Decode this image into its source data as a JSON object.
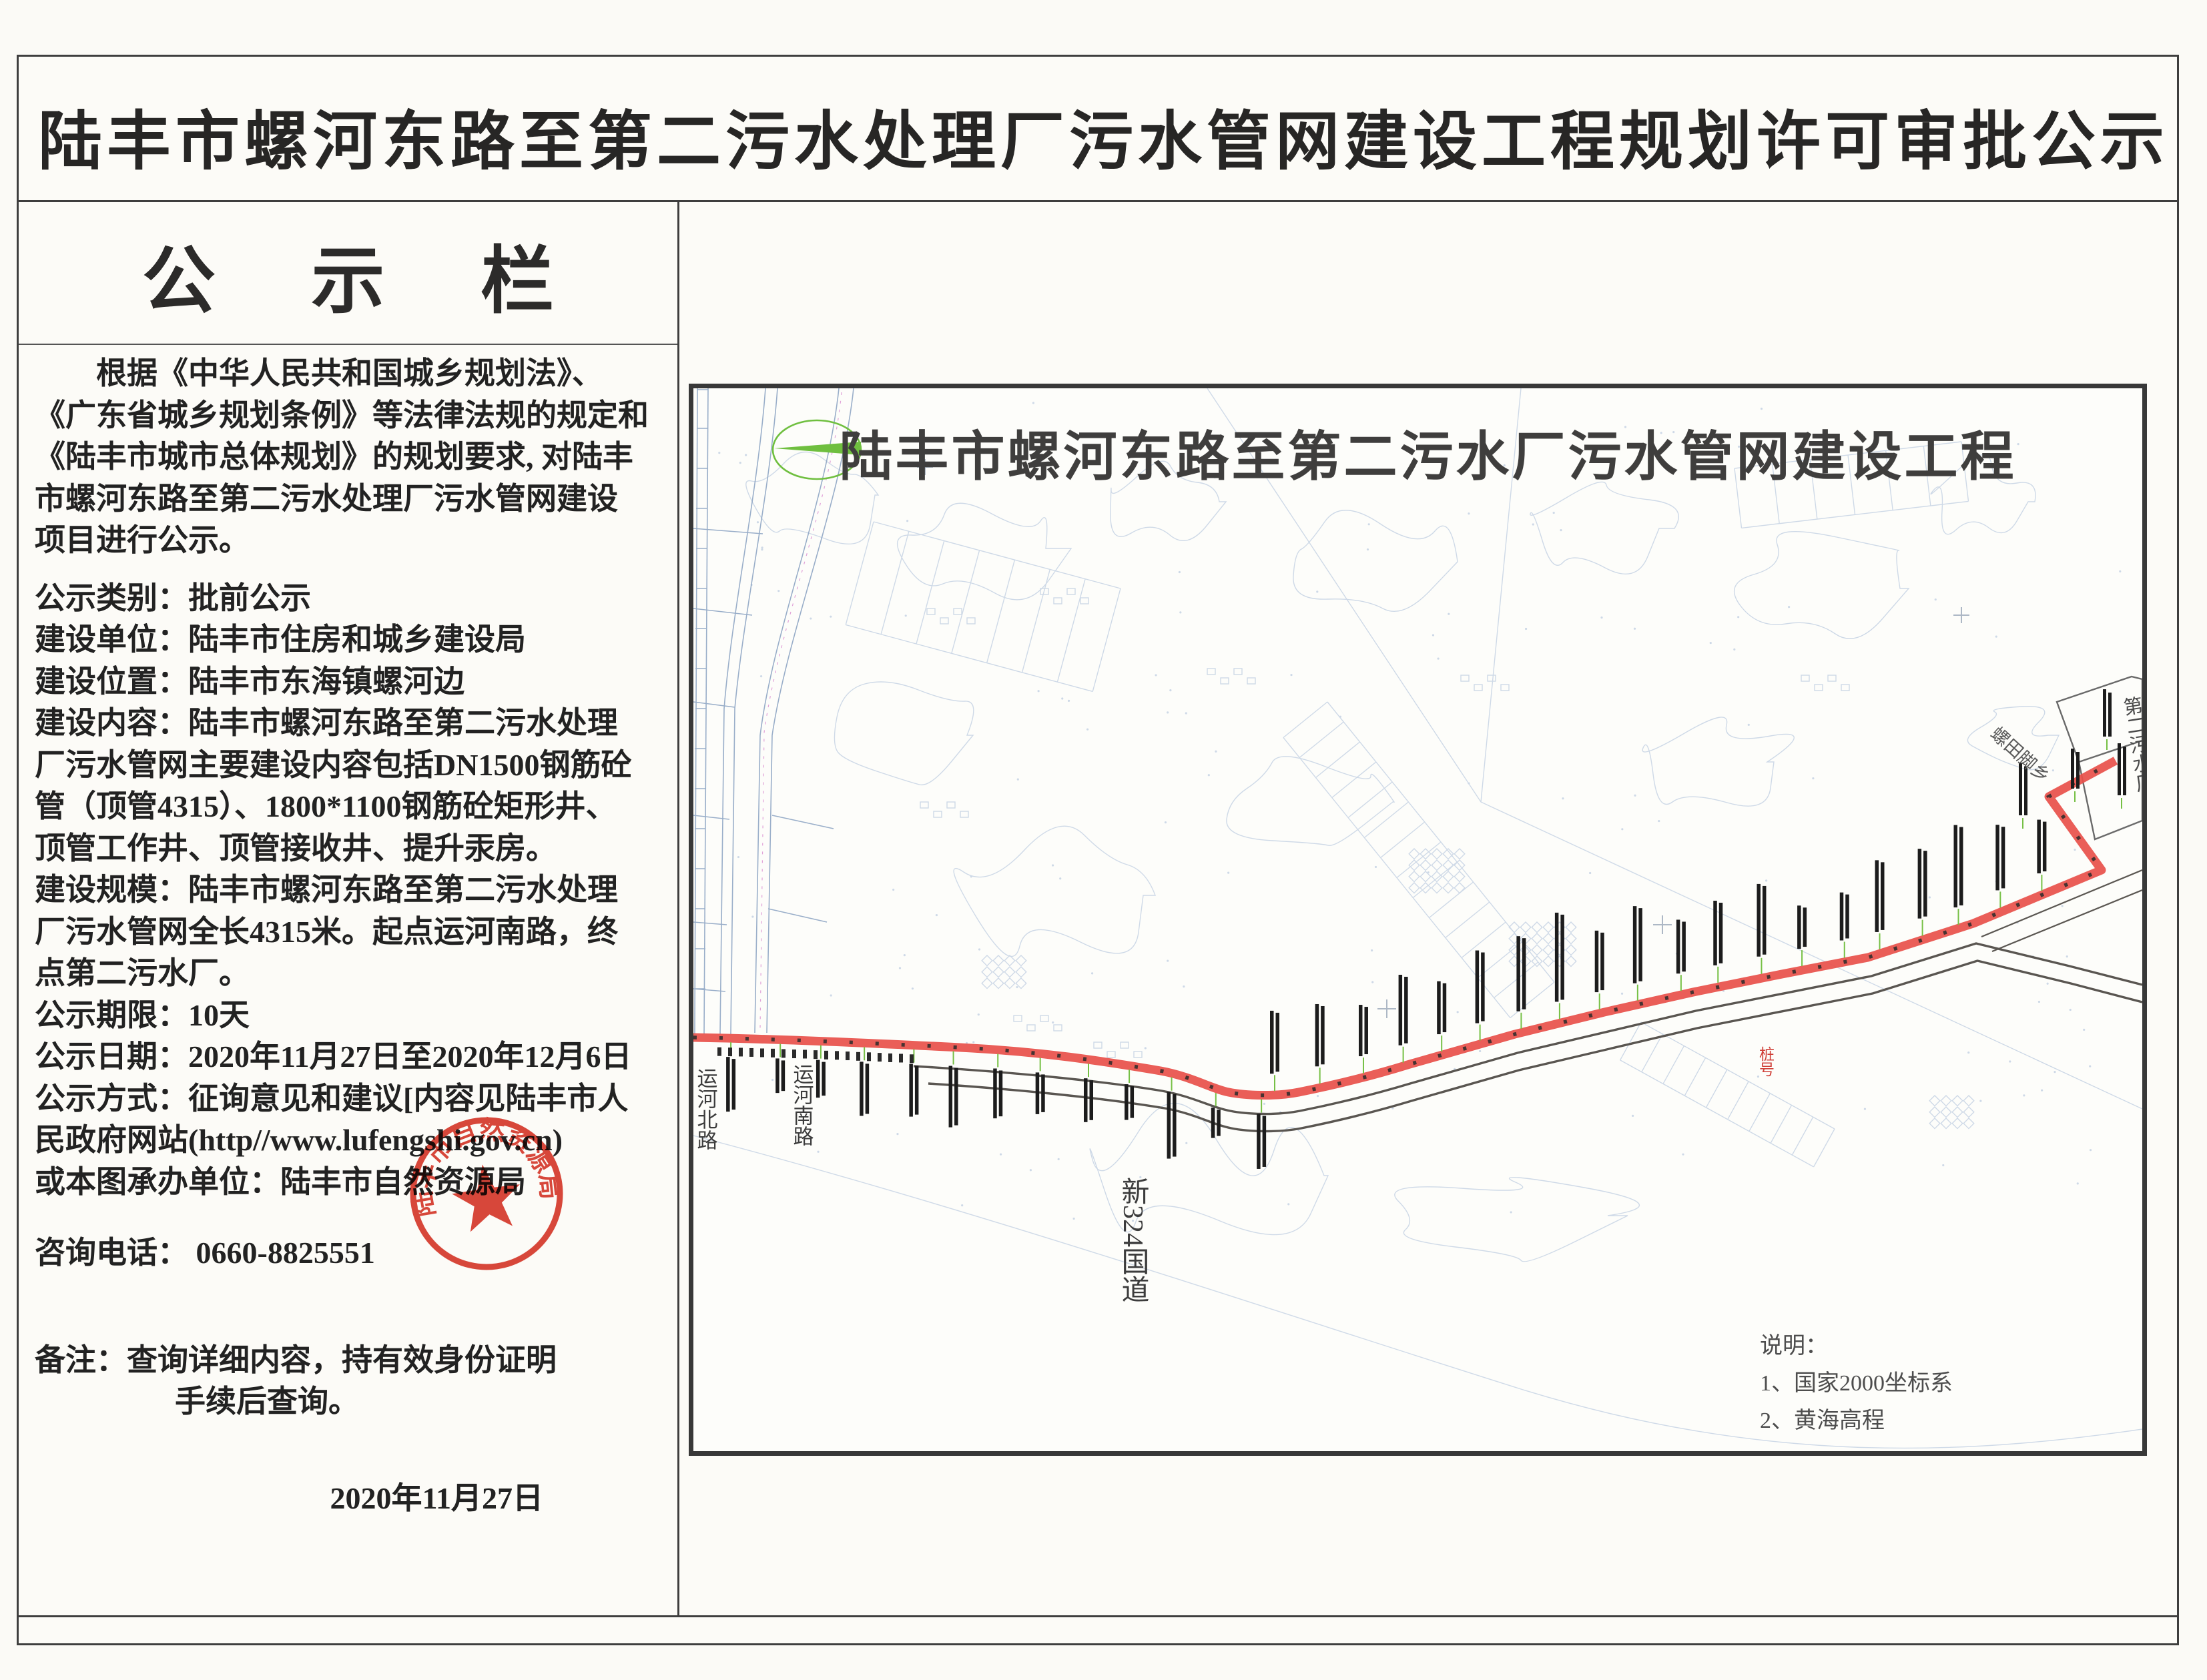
{
  "page": {
    "main_title": "陆丰市螺河东路至第二污水处理厂污水管网建设工程规划许可审批公示"
  },
  "notice": {
    "heading": "公 示 栏",
    "para": [
      "根据《中华人民共和国城乡规划法》、",
      "《广东省城乡规划条例》等法律法规的规定和",
      "《陆丰市城市总体规划》的规划要求, 对陆丰",
      "市螺河东路至第二污水处理厂污水管网建设",
      "项目进行公示。"
    ],
    "details": [
      "公示类别：批前公示",
      "建设单位：陆丰市住房和城乡建设局",
      "建设位置：陆丰市东海镇螺河边",
      "建设内容：陆丰市螺河东路至第二污水处理",
      "厂污水管网主要建设内容包括DN1500钢筋砼",
      "管（顶管4315）、1800*1100钢筋砼矩形井、",
      "顶管工作井、顶管接收井、提升汞房。",
      "建设规模：陆丰市螺河东路至第二污水处理",
      "厂污水管网全长4315米。起点运河南路，终",
      "点第二污水厂。",
      "公示期限：10天",
      "公示日期：2020年11月27日至2020年12月6日",
      "公示方式：征询意见和建议[内容见陆丰市人",
      "民政府网站(http//www.lufengshi.gov.cn)",
      "或本图承办单位：陆丰市自然资源局"
    ],
    "phone_line": "咨询电话：  0660-8825551",
    "note_line1": "备注：查询详细内容，持有效身份证明",
    "note_line2": "手续后查询。",
    "date": "2020年11月27日",
    "stamp": {
      "text": "陆丰市自然资源局",
      "color": "#d63426"
    }
  },
  "map": {
    "title": "陆丰市螺河东路至第二污水厂污水管网建设工程",
    "legend": {
      "heading": "说明：",
      "item1": "1、国家2000坐标系",
      "item2": "2、黄海高程"
    },
    "labels": {
      "road_north": "运河北路",
      "road_south": "运河南路",
      "road_g324": "新324国道",
      "village": "螺田脚乡",
      "plant": "第二污水厂",
      "chainage": "桩号"
    },
    "colors": {
      "route_red": "#e8504a",
      "leader_green": "#76c045",
      "compass_green": "#6fbf3f",
      "map_line_blue": "#a9bdd8",
      "road_dark": "#5a5651"
    }
  }
}
